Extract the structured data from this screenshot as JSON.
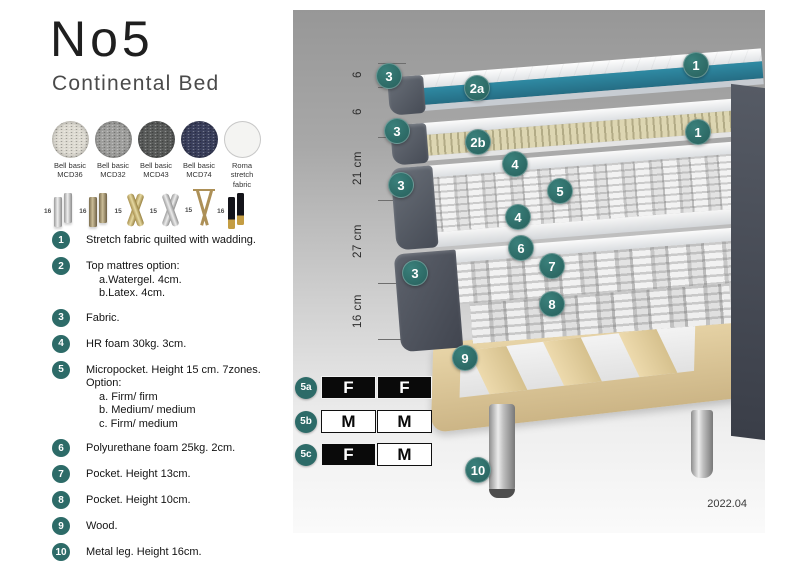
{
  "header": {
    "title": "No5",
    "subtitle": "Continental Bed"
  },
  "fabric_swatches": [
    {
      "label_line1": "Bell basic",
      "label_line2": "MCD36",
      "color": "#dedbd2"
    },
    {
      "label_line1": "Bell basic",
      "label_line2": "MCD32",
      "color": "#9f9f9d"
    },
    {
      "label_line1": "Bell basic",
      "label_line2": "MCD43",
      "color": "#595b5a"
    },
    {
      "label_line1": "Bell basic",
      "label_line2": "MCD74",
      "color": "#3a3f5c"
    },
    {
      "label_line1": "Roma",
      "label_line2": "stretch fabric",
      "color": "#f4f4f2"
    }
  ],
  "leg_options": [
    {
      "height_cm": "16",
      "name": "chrome cylinder legs"
    },
    {
      "height_cm": "16",
      "name": "bronze cylinder legs"
    },
    {
      "height_cm": "15",
      "name": "gold twisted legs"
    },
    {
      "height_cm": "15",
      "name": "silver twisted legs"
    },
    {
      "height_cm": "15",
      "name": "gold hairpin legs"
    },
    {
      "height_cm": "16",
      "name": "black gold-tip legs"
    }
  ],
  "legend_items": [
    {
      "num": "1",
      "lines": [
        "Stretch fabric quilted with wadding."
      ]
    },
    {
      "num": "2",
      "lines": [
        "Top mattres option:",
        "a.Watergel. 4cm.",
        "b.Latex. 4cm."
      ]
    },
    {
      "num": "3",
      "lines": [
        "Fabric."
      ]
    },
    {
      "num": "4",
      "lines": [
        "HR foam 30kg. 3cm."
      ]
    },
    {
      "num": "5",
      "lines": [
        "Micropocket. Height 15 cm. 7zones. Option:",
        "a. Firm/ firm",
        "b. Medium/ medium",
        "c. Firm/ medium"
      ]
    },
    {
      "num": "6",
      "lines": [
        "Polyurethane foam 25kg. 2cm."
      ]
    },
    {
      "num": "7",
      "lines": [
        "Pocket. Height 13cm."
      ]
    },
    {
      "num": "8",
      "lines": [
        "Pocket. Height 10cm."
      ]
    },
    {
      "num": "9",
      "lines": [
        "Wood."
      ]
    },
    {
      "num": "10",
      "lines": [
        "Metal leg. Height 16cm."
      ]
    }
  ],
  "diagram": {
    "dimension_labels": [
      "6",
      "6",
      "21 cm",
      "27 cm",
      "16 cm"
    ],
    "markers": [
      {
        "label": "3"
      },
      {
        "label": "2a"
      },
      {
        "label": "1"
      },
      {
        "label": "3"
      },
      {
        "label": "2b"
      },
      {
        "label": "1"
      },
      {
        "label": "4"
      },
      {
        "label": "5"
      },
      {
        "label": "4"
      },
      {
        "label": "3"
      },
      {
        "label": "6"
      },
      {
        "label": "7"
      },
      {
        "label": "3"
      },
      {
        "label": "8"
      },
      {
        "label": "9"
      },
      {
        "label": "10"
      }
    ],
    "firmness_tables": [
      {
        "label": "5a",
        "cells": [
          {
            "text": "F",
            "variant": "dark"
          },
          {
            "text": "F",
            "variant": "dark"
          }
        ]
      },
      {
        "label": "5b",
        "cells": [
          {
            "text": "M",
            "variant": "light"
          },
          {
            "text": "M",
            "variant": "light"
          }
        ]
      },
      {
        "label": "5c",
        "cells": [
          {
            "text": "F",
            "variant": "dark"
          },
          {
            "text": "M",
            "variant": "light"
          }
        ]
      }
    ],
    "version": "2022.04"
  },
  "colors": {
    "accent_teal": "#2d6b68",
    "watergel_teal": "#2c7d95",
    "latex_tan": "#d9d3ae",
    "bed_side_slate": "#555a64",
    "wood": "#e2cda0"
  }
}
